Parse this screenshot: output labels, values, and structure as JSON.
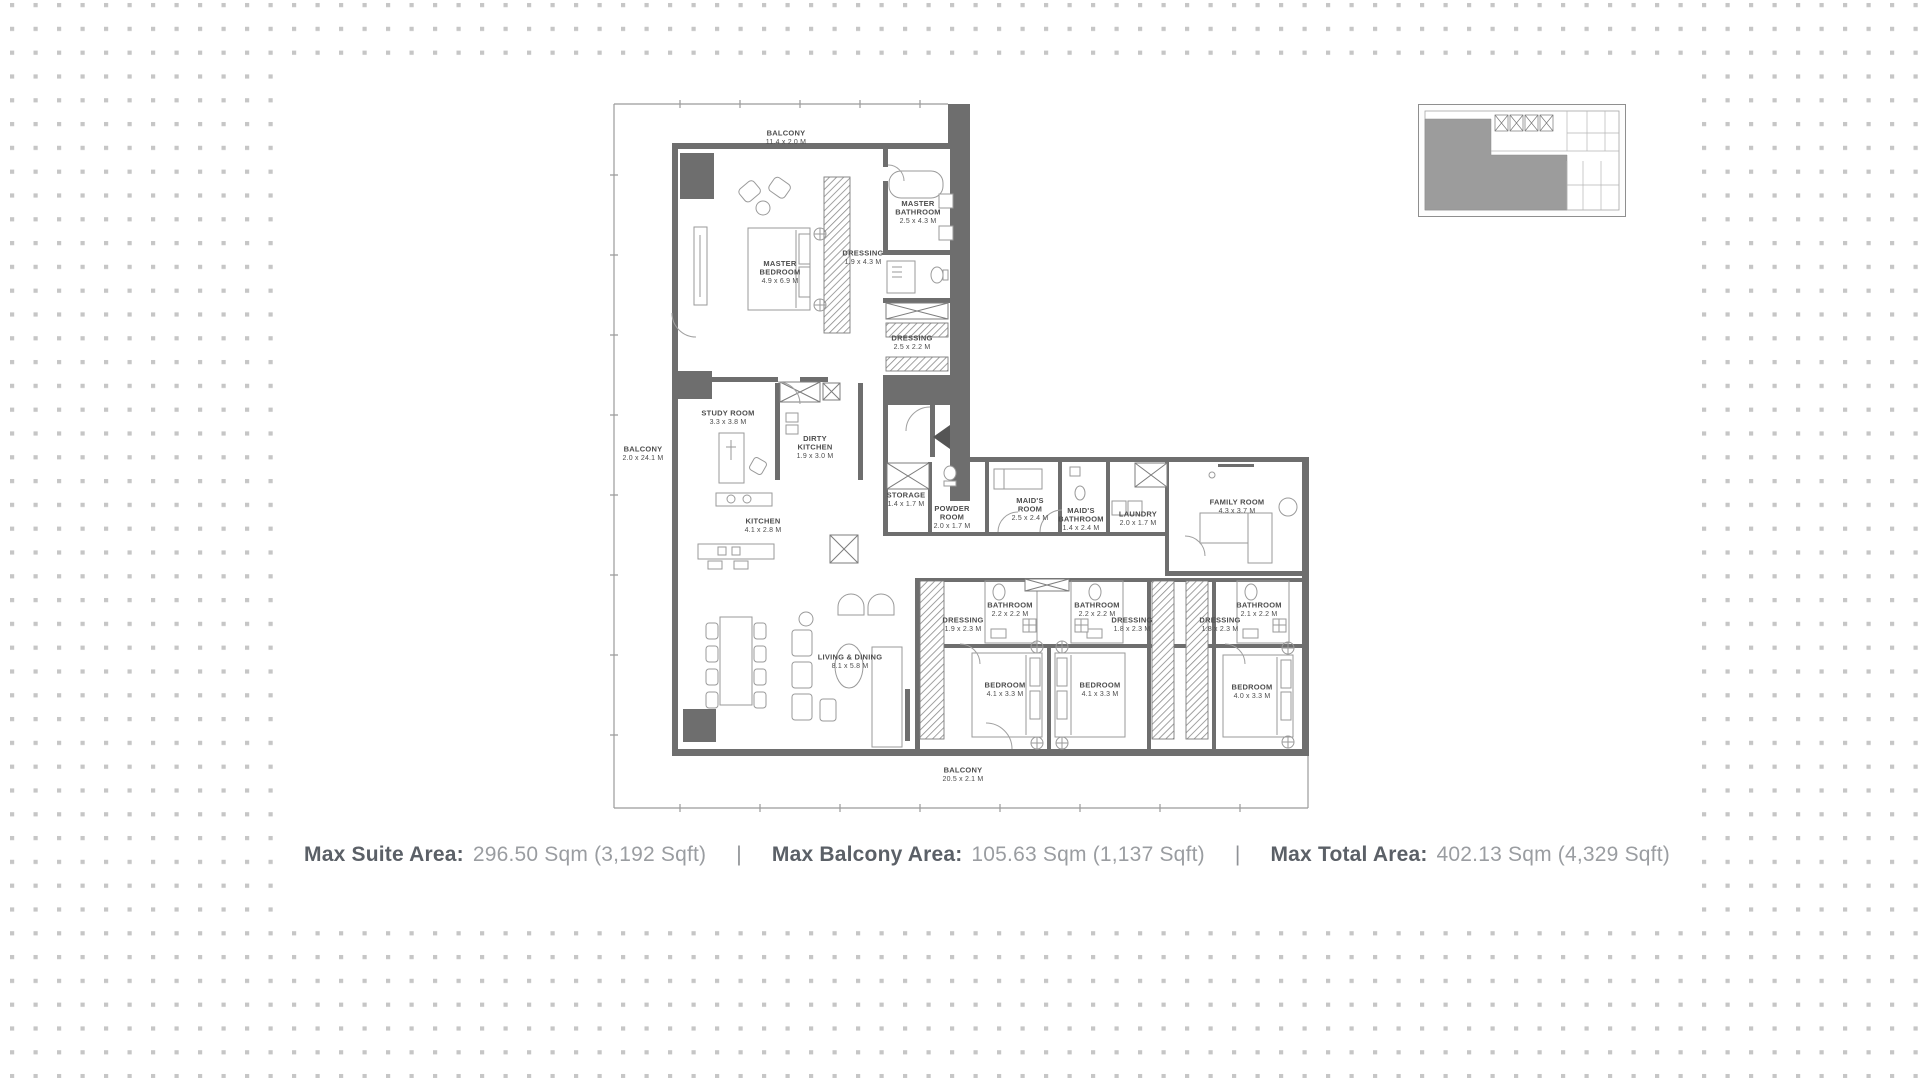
{
  "colors": {
    "wall": "#6e6e6e",
    "outline": "#9b9b9b",
    "plan_label": "#4d4d4d",
    "background_dot": "#c6c6c6",
    "stat_label": "#5b6067",
    "stat_value": "#9a9da1",
    "keyplan_highlight": "#9c9c9c"
  },
  "stats": {
    "separator": "|",
    "items": [
      {
        "label": "Max Suite Area:",
        "value": "296.50 Sqm (3,192 Sqft)"
      },
      {
        "label": "Max Balcony Area:",
        "value": "105.63 Sqm (1,137 Sqft)"
      },
      {
        "label": "Max Total Area:",
        "value": "402.13 Sqm (4,329 Sqft)"
      }
    ]
  },
  "floor_plan": {
    "rooms": [
      {
        "l1": "MASTER",
        "l2": "BEDROOM",
        "d": "4.9 x 6.9 M",
        "x": 180,
        "y": 177
      },
      {
        "l1": "MASTER",
        "l2": "BATHROOM",
        "d": "2.5 x 4.3 M",
        "x": 318,
        "y": 117
      },
      {
        "l1": "DRESSING",
        "l2": "",
        "d": "1.9 x 4.3 M",
        "x": 263,
        "y": 162
      },
      {
        "l1": "DRESSING",
        "l2": "",
        "d": "2.5 x 2.2 M",
        "x": 312,
        "y": 247
      },
      {
        "l1": "STUDY ROOM",
        "l2": "",
        "d": "3.3 x 3.8 M",
        "x": 128,
        "y": 322
      },
      {
        "l1": "DIRTY",
        "l2": "KITCHEN",
        "d": "1.9 x 3.0 M",
        "x": 215,
        "y": 352
      },
      {
        "l1": "KITCHEN",
        "l2": "",
        "d": "4.1 x 2.8 M",
        "x": 163,
        "y": 430
      },
      {
        "l1": "STORAGE",
        "l2": "",
        "d": "1.4 x 1.7 M",
        "x": 306,
        "y": 404
      },
      {
        "l1": "POWDER",
        "l2": "ROOM",
        "d": "2.0 x 1.7 M",
        "x": 352,
        "y": 422
      },
      {
        "l1": "MAID'S",
        "l2": "ROOM",
        "d": "2.5 x 2.4 M",
        "x": 430,
        "y": 414
      },
      {
        "l1": "MAID'S",
        "l2": "BATHROOM",
        "d": "1.4 x 2.4 M",
        "x": 481,
        "y": 424
      },
      {
        "l1": "LAUNDRY",
        "l2": "",
        "d": "2.0 x 1.7 M",
        "x": 538,
        "y": 423
      },
      {
        "l1": "FAMILY ROOM",
        "l2": "",
        "d": "4.3 x 3.7 M",
        "x": 637,
        "y": 411
      },
      {
        "l1": "DRESSING",
        "l2": "",
        "d": "1.9 x 2.3 M",
        "x": 363,
        "y": 529
      },
      {
        "l1": "BATHROOM",
        "l2": "",
        "d": "2.2 x 2.2 M",
        "x": 410,
        "y": 514
      },
      {
        "l1": "BATHROOM",
        "l2": "",
        "d": "2.2 x 2.2 M",
        "x": 497,
        "y": 514
      },
      {
        "l1": "DRESSING",
        "l2": "",
        "d": "1.8 x 2.3 M",
        "x": 532,
        "y": 529
      },
      {
        "l1": "DRESSING",
        "l2": "",
        "d": "1.8 x 2.3 M",
        "x": 620,
        "y": 529
      },
      {
        "l1": "BATHROOM",
        "l2": "",
        "d": "2.1 x 2.2 M",
        "x": 659,
        "y": 514
      },
      {
        "l1": "LIVING & DINING",
        "l2": "",
        "d": "8.1 x 5.8 M",
        "x": 250,
        "y": 566
      },
      {
        "l1": "BEDROOM",
        "l2": "",
        "d": "4.1 x 3.3 M",
        "x": 405,
        "y": 594
      },
      {
        "l1": "BEDROOM",
        "l2": "",
        "d": "4.1 x 3.3 M",
        "x": 500,
        "y": 594
      },
      {
        "l1": "BEDROOM",
        "l2": "",
        "d": "4.0 x 3.3 M",
        "x": 652,
        "y": 596
      }
    ],
    "balconies": [
      {
        "l1": "BALCONY",
        "d": "11.4 x 2.0 M",
        "x": 186,
        "y": 42
      },
      {
        "l1": "BALCONY",
        "d": "2.0 x 24.1 M",
        "x": 43,
        "y": 358
      },
      {
        "l1": "BALCONY",
        "d": "20.5 x 2.1 M",
        "x": 363,
        "y": 679
      }
    ]
  }
}
